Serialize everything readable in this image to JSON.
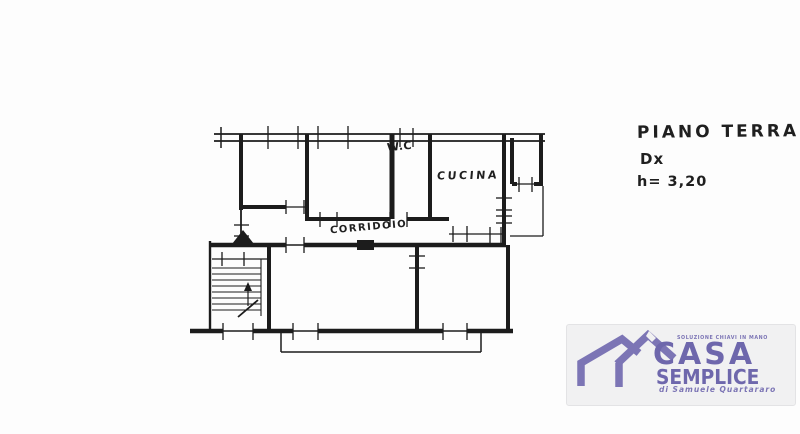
{
  "plan": {
    "title": "PIANO TERRA",
    "unit": "Dx",
    "ceiling_height": "h= 3,20",
    "labels": {
      "wc": "W.C",
      "kitchen": "CUCINA",
      "corridor": "CORRIDOIO"
    }
  },
  "logo": {
    "tagline": "SOLUZIONE CHIAVI IN MANO",
    "brand_top": "CASA",
    "brand_bottom": "SEMPLICE",
    "byline": "di Samuele Quartararo"
  },
  "colors": {
    "ink": "#1c1c1c",
    "paper": "#fdfdfd",
    "logo_purple": "#7c75b5",
    "logo_text": "#6e67ac",
    "logo_bg": "#f1f1f2"
  }
}
